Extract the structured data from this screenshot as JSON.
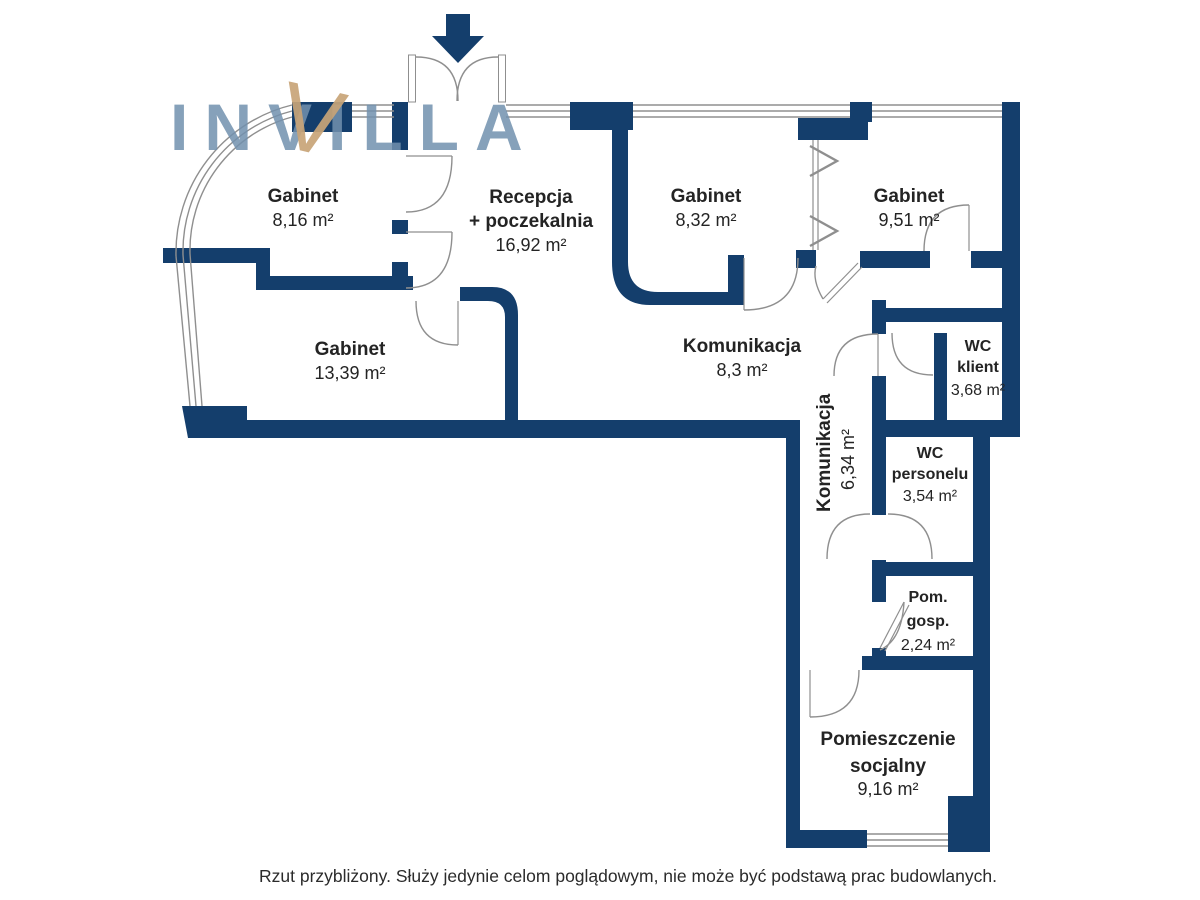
{
  "logo": {
    "text": "INVILLA",
    "accent_letter": "V"
  },
  "entrance": {
    "arrow_icon": "down-arrow"
  },
  "rooms": [
    {
      "id": "gabinet-1",
      "name": "Gabinet",
      "area": "8,16 m²"
    },
    {
      "id": "recepcja",
      "name": "Recepcja",
      "name2": "+ poczekalnia",
      "area": "16,92 m²"
    },
    {
      "id": "gabinet-2",
      "name": "Gabinet",
      "area": "8,32 m²"
    },
    {
      "id": "gabinet-3",
      "name": "Gabinet",
      "area": "9,51 m²"
    },
    {
      "id": "gabinet-4",
      "name": "Gabinet",
      "area": "13,39 m²"
    },
    {
      "id": "komunikacja-1",
      "name": "Komunikacja",
      "area": "8,3 m²"
    },
    {
      "id": "wc-klient",
      "name": "WC",
      "name2": "klient",
      "area": "3,68 m²"
    },
    {
      "id": "komunikacja-2",
      "name": "Komunikacja",
      "area": "6,34 m²"
    },
    {
      "id": "wc-personelu",
      "name": "WC",
      "name2": "personelu",
      "area": "3,54 m²"
    },
    {
      "id": "pom-gosp",
      "name": "Pom.",
      "name2": "gosp.",
      "area": "2,24 m²"
    },
    {
      "id": "pom-socjalny",
      "name": "Pomieszczenie",
      "name2": "socjalny",
      "area": "9,16 m²"
    }
  ],
  "disclaimer": "Rzut przybliżony. Służy jedynie celom poglądowym, nie może być podstawą prac budowlanych.",
  "colors": {
    "wall": "#143e6c",
    "logo_blue": "#7291ae",
    "logo_gold": "#c8a478",
    "door_line": "#8f8f8f",
    "text": "#242424"
  }
}
